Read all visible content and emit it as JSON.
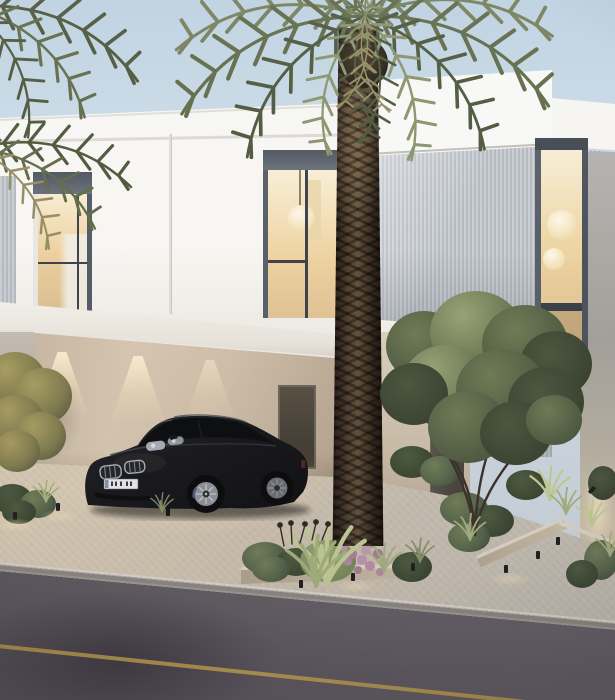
{
  "meta": {
    "title": "Villa exterior rendering",
    "description": "Dusk architectural rendering of a modern white two-storey villa with warm-lit windows, a covered carport sheltering a black coupe, a tall date palm in front, grey slat cladding, landscaped planter beds with small path lights, and an asphalt road with a yellow edge line in the foreground.",
    "time_of_day": "dusk",
    "visible_text": "none"
  },
  "objects": {
    "sky": {
      "label": "pale dusk sky"
    },
    "villa": {
      "label": "white modern villa facade"
    },
    "upper_window_left": {
      "label": "tall lit window on upper floor, left"
    },
    "upper_window_center": {
      "label": "tall lit window with globe pendant lamp"
    },
    "window_right": {
      "label": "double-height lit window with globe pendant lamps"
    },
    "slat_cladding": {
      "label": "grey vertical slat cladding"
    },
    "carport": {
      "label": "covered carport with wall-wash downlights",
      "downlight_count": 3
    },
    "car": {
      "label": "black luxury coupe parked in carport",
      "license_plate": "illegible"
    },
    "palm": {
      "label": "tall date palm tree"
    },
    "left_palm": {
      "label": "palm fronds entering frame at top left"
    },
    "entrance": {
      "label": "recessed entrance with white canopy and dark door"
    },
    "entrance_tree": {
      "label": "ornamental multi-trunk tree by the entrance"
    },
    "left_tree": {
      "label": "olive-gold tree against boundary wall"
    },
    "planters": {
      "label": "landscaped planter beds with path lights",
      "path_light_count": 9
    },
    "road": {
      "label": "asphalt road with yellow edge line"
    }
  },
  "colors": {
    "sky_top": "#c0d3e2",
    "sky_low": "#e4eaee",
    "wall": "#f7f6f2",
    "wall_warm": "#efece6",
    "wall_shade": "#d9d4cc",
    "reveal_dark": "#59606a",
    "frame_dark": "#3d444c",
    "glass_warm_1": "#f8edd2",
    "glass_warm_2": "#eccf9e",
    "glass_warm_3": "#d8bd92",
    "curtain": "#f0eadf",
    "slat_a": "#cbcfd4",
    "slat_b": "#b5bac1",
    "soffit": "#f2efe9",
    "carport_wall": "#d9c9b3",
    "carport_wall_dark": "#b5a48e",
    "door_dark": "#4b463e",
    "car_body": "#141519",
    "car_highlight": "#35383e",
    "wheel_rim": "#8f9398",
    "plate": "#ebebe8",
    "trunk_light": "#5a4936",
    "trunk_dark": "#1e1710",
    "frond_1": "#77815c",
    "frond_2": "#616c49",
    "frond_3": "#8a946c",
    "frond_4": "#4e583c",
    "frond_dry": "#968d64",
    "tree_light": "#9aa478",
    "tree_mid": "#707d56",
    "tree_dark": "#4c5840",
    "left_tree_light": "#ab9f63",
    "left_tree_mid": "#837f50",
    "left_tree_dark": "#565840",
    "grass_light": "#c6cf9a",
    "grass_mid": "#a8b37f",
    "flower_pink": "#b98fa8",
    "planter_cap": "#ded8cb",
    "planter_face": "#b3a791",
    "paving_warm": "#dbcdb6",
    "paving_cool": "#c6c0b5",
    "road_light": "#7e7780",
    "road_dark": "#57525a",
    "curb_top": "#ddd8d0",
    "curb_face": "#8e8983",
    "lane_yellow": "#c0a050",
    "glow_warm": "#f6e4bc"
  }
}
